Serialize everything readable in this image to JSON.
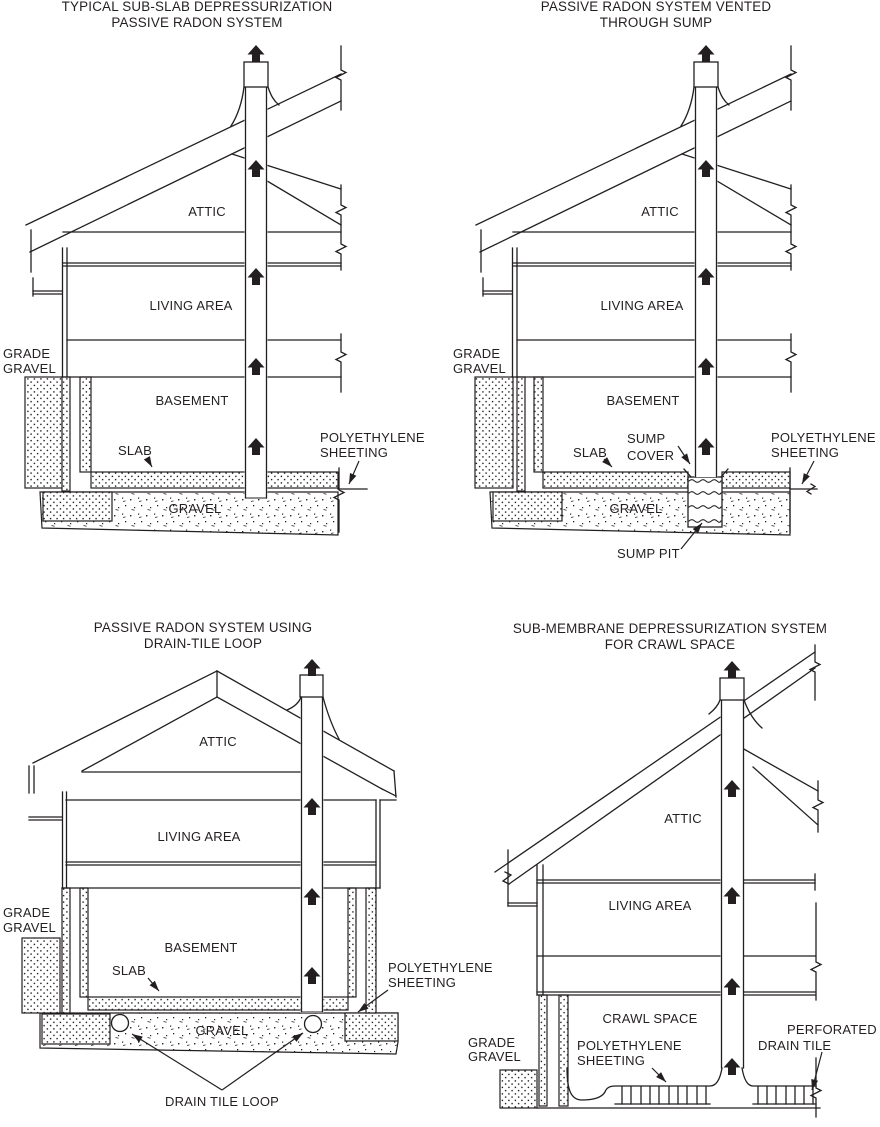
{
  "page": {
    "background": "#ffffff",
    "ink": "#231f20"
  },
  "panels": [
    {
      "name": "typical-sub-slab",
      "title1": "TYPICAL SUB-SLAB DEPRESSURIZATION",
      "title2": "PASSIVE RADON SYSTEM",
      "attic": "ATTIC",
      "living": "LIVING AREA",
      "grade1": "GRADE",
      "grade2": "GRAVEL",
      "basement": "BASEMENT",
      "slab": "SLAB",
      "poly1": "POLYETHYLENE",
      "poly2": "SHEETING",
      "gravel": "GRAVEL"
    },
    {
      "name": "vented-through-sump",
      "title1": "PASSIVE RADON SYSTEM VENTED",
      "title2": "THROUGH SUMP",
      "attic": "ATTIC",
      "living": "LIVING AREA",
      "grade1": "GRADE",
      "grade2": "GRAVEL",
      "basement": "BASEMENT",
      "slab": "SLAB",
      "sump1": "SUMP",
      "sump2": "COVER",
      "poly1": "POLYETHYLENE",
      "poly2": "SHEETING",
      "gravel": "GRAVEL",
      "sump_pit": "SUMP PIT"
    },
    {
      "name": "drain-tile-loop",
      "title1": "PASSIVE RADON SYSTEM USING",
      "title2": "DRAIN-TILE LOOP",
      "attic": "ATTIC",
      "living": "LIVING AREA",
      "grade1": "GRADE",
      "grade2": "GRAVEL",
      "basement": "BASEMENT",
      "slab": "SLAB",
      "poly1": "POLYETHYLENE",
      "poly2": "SHEETING",
      "gravel": "GRAVEL",
      "drain_tile_loop": "DRAIN TILE LOOP"
    },
    {
      "name": "crawl-space",
      "title1": "SUB-MEMBRANE DEPRESSURIZATION SYSTEM",
      "title2": "FOR CRAWL SPACE",
      "attic": "ATTIC",
      "living": "LIVING AREA",
      "crawl": "CRAWL SPACE",
      "grade1": "GRADE",
      "grade2": "GRAVEL",
      "poly1": "POLYETHYLENE",
      "poly2": "SHEETING",
      "perf1": "PERFORATED",
      "perf2": "DRAIN TILE"
    }
  ]
}
